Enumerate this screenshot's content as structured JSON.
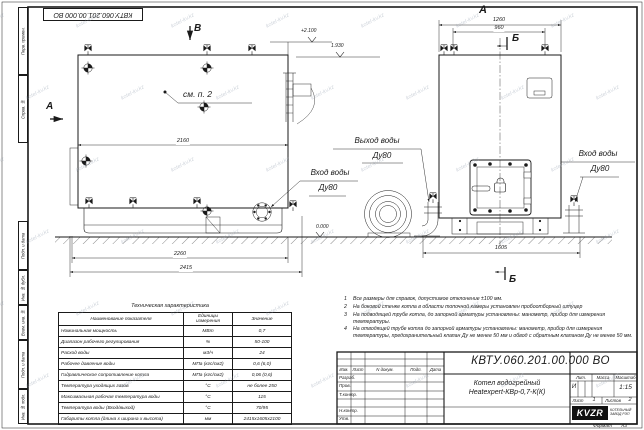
{
  "sheet": {
    "stamp_top": "КВТУ.060.201.00.000  ВО",
    "watermark": "kotel-kv.kz",
    "format_label": "Формат",
    "format_value": "А3"
  },
  "margin_strip": {
    "top": [
      "Перв. примен.",
      "Справ. №"
    ],
    "bottom": [
      "Подп. и дата",
      "Инв. № дубл.",
      "Взам. инв. №",
      "Подп. и дата",
      "Инв. № подл."
    ]
  },
  "views": {
    "main": {
      "view_label_top": "В",
      "view_label_left": "А",
      "see_note": "см. п. 2",
      "elev_top": "+2.100",
      "elev_flue": "1.930",
      "elev_ground": "0.000",
      "dim_inner_width": "2160",
      "dim_frame_width": "2260",
      "dim_total_width": "2415",
      "inlet_label": "Вход воды",
      "inlet_dn": "Ду80"
    },
    "front": {
      "view_label": "А",
      "section_label_top": "Б",
      "section_label_bottom": "Б",
      "dim_top_total": "1260",
      "dim_top_inner": "960",
      "dim_base_width": "1605",
      "outlet_label": "Выход воды",
      "outlet_dn": "Ду80",
      "inlet_label": "Вход воды",
      "inlet_dn": "Ду80"
    }
  },
  "notes": [
    {
      "n": "1",
      "text": "Все размеры для справок, допустимое отклонение ±100 мм."
    },
    {
      "n": "2",
      "text": "На боковой стенке котла в области топочной камеры установлен пробоотборный штуцер"
    },
    {
      "n": "3",
      "text": "На  подводящей трубе котла, до запорной арматуры установлены: манометр, прибор для измерения температуры."
    },
    {
      "n": "4",
      "text": "На отводящей трубе котла до запорной арматуры установлены: манометр, прибор для измерения температуры, предохранительный клапан Ду не менее 50 мм и обвод с обратным клапаном Ду не менее 50 мм."
    }
  ],
  "spec_table": {
    "title": "Техническая характеристика",
    "headers": [
      "Наименование показателя",
      "Единицы\nизмерения",
      "Значение"
    ],
    "rows": [
      [
        "Номинальная мощность",
        "МВт",
        "0,7"
      ],
      [
        "Диапазон рабочего регулирования",
        "%",
        "50-100"
      ],
      [
        "Расход воды",
        "м3/ч",
        "24"
      ],
      [
        "Рабочее давление воды",
        "МПа (кгс/см2)",
        "0,6 (6,0)"
      ],
      [
        "Гидравлическое сопротивление котла",
        "МПа (кгс/см2)",
        "0,06 (0,6)"
      ],
      [
        "Температура уходящих газов",
        "°С",
        "не более 250"
      ],
      [
        "Максимальная рабочая температура воды",
        "°С",
        "115"
      ],
      [
        "Температура воды (Вход/выход)",
        "°С",
        "70/95"
      ],
      [
        "Габариты котла (длина х ширина х высота)",
        "мм",
        "2415х1605х2100"
      ]
    ]
  },
  "title_block": {
    "doc_number": "КВТУ.060.201.00.000  ВО",
    "product_line1": "Котел водогрейный",
    "product_line2": "Heatexpert-КВр-0,7-К(К)",
    "cols": {
      "izm": "Изм.",
      "list": "Лист",
      "ndoc": "N докум.",
      "podp": "Подп.",
      "data": "Дата"
    },
    "rows": {
      "razrab": "Разраб.",
      "prov": "Пров.",
      "tkontr": "Т.контр.",
      "nkontr": "Н.контр.",
      "utv": "Утв."
    },
    "lit_label": "Лит.",
    "lit_value": "И",
    "mass_label": "Масса",
    "scale_label": "Масштаб",
    "scale_value": "1:15",
    "sheet_label": "Лист",
    "sheet_value": "1",
    "sheets_label": "Листов",
    "sheets_value": "2",
    "logo_text": "KVZR",
    "logo_caption1": "КОТЕЛЬНЫЙ",
    "logo_caption2": "ЗАВОД РЭП"
  }
}
